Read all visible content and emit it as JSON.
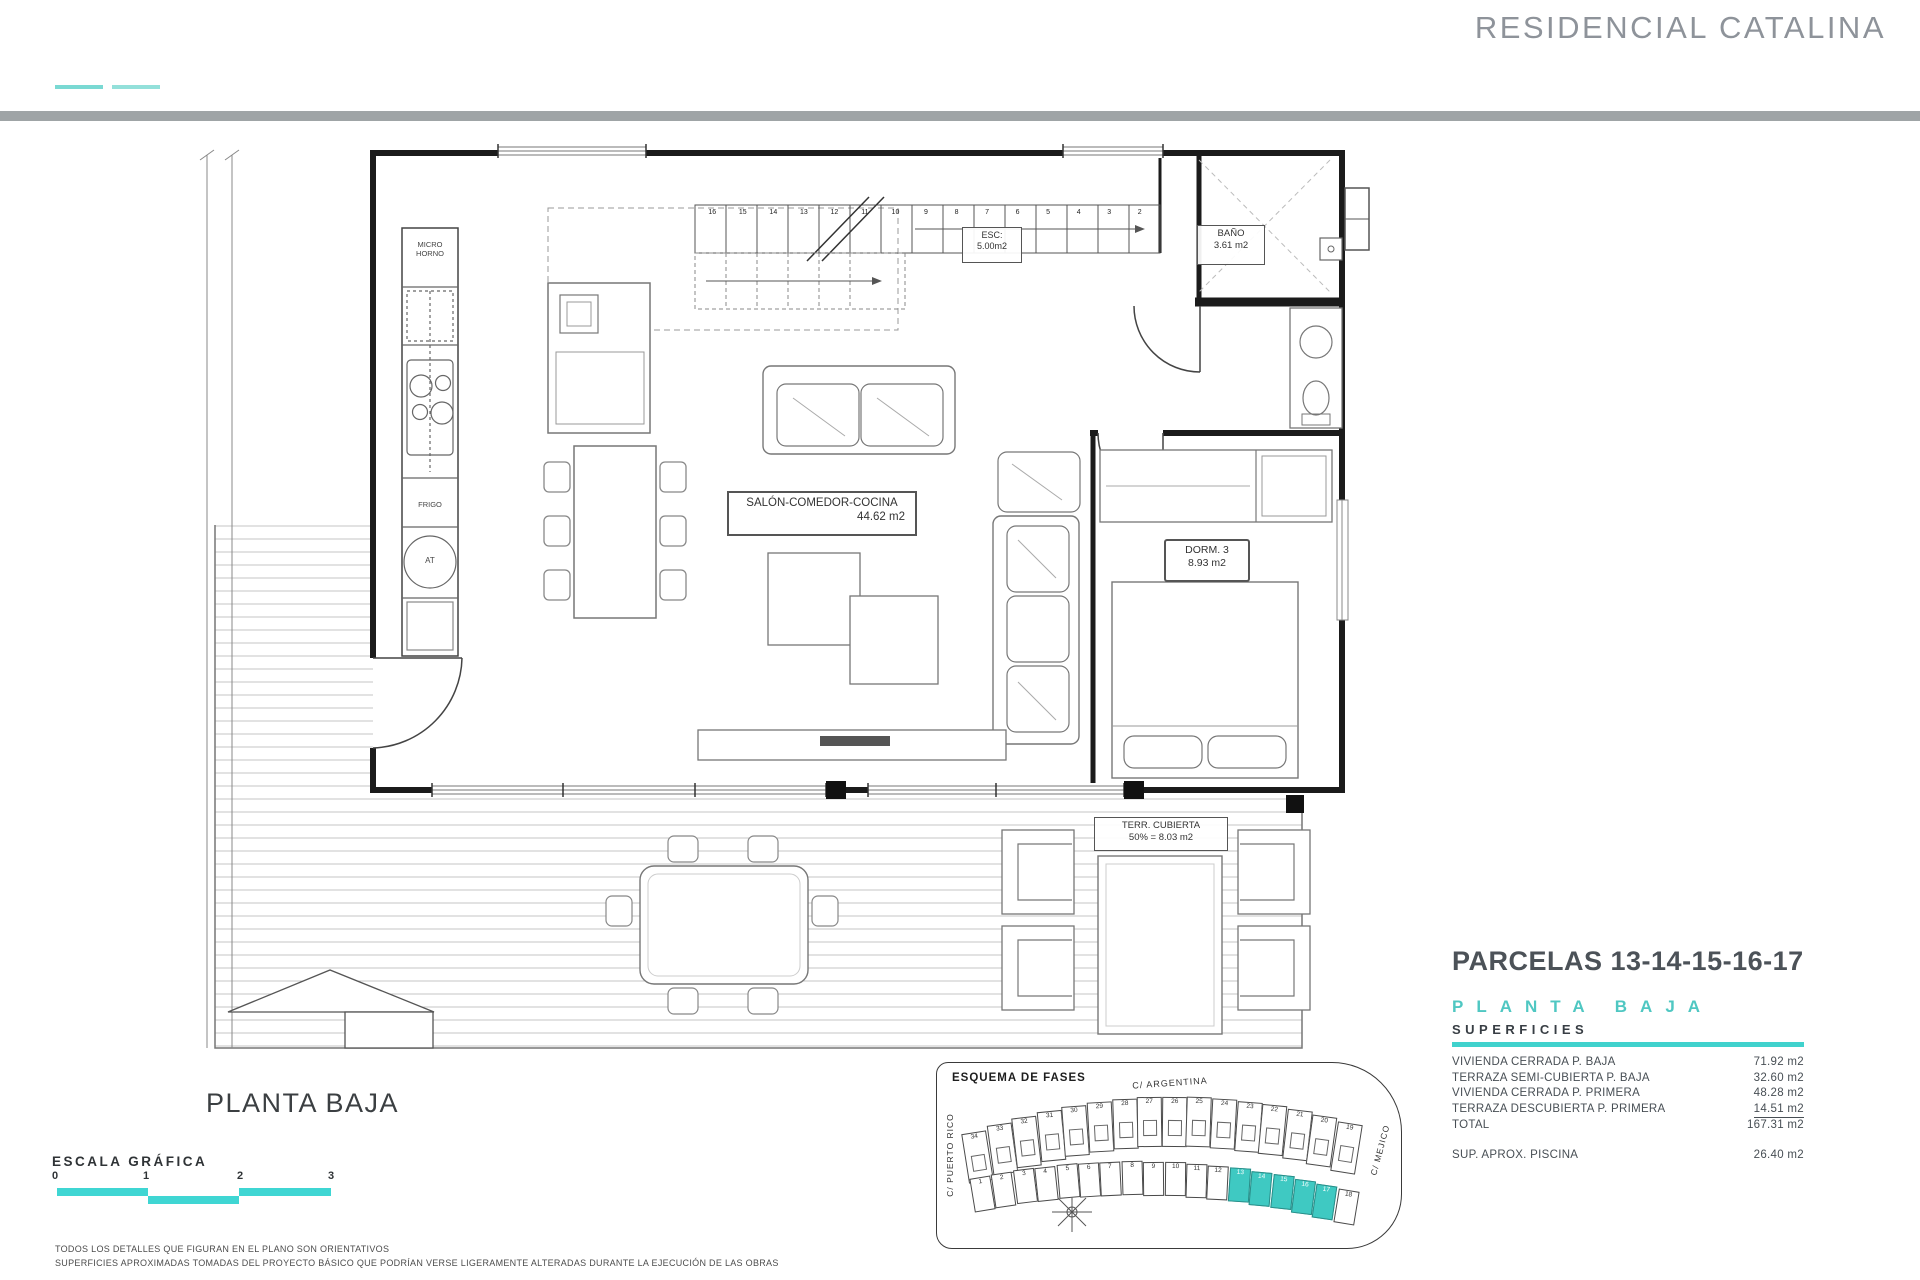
{
  "header": {
    "title": "RESIDENCIAL CATALINA"
  },
  "plan_labels": {
    "micro": "MICRO\nHORNO",
    "frigo": "FRIGO",
    "at": "AT",
    "esc_line1": "ESC:",
    "esc_line2": "5.00m2",
    "bano_line1": "BAÑO",
    "bano_line2": "3.61 m2",
    "salon_line1": "SALÓN-COMEDOR-COCINA",
    "salon_line2": "44.62 m2",
    "dorm_line1": "DORM. 3",
    "dorm_line2": "8.93 m2",
    "terr_line1": "TERR. CUBIERTA",
    "terr_line2": "50% = 8.03 m2"
  },
  "stairs": {
    "numbers": [
      "16",
      "15",
      "14",
      "13",
      "12",
      "11",
      "10",
      "9",
      "8",
      "7",
      "6",
      "5",
      "4",
      "3",
      "2"
    ]
  },
  "titles": {
    "plan_title": "PLANTA BAJA"
  },
  "scale": {
    "title": "ESCALA GRÁFICA",
    "ticks": [
      "0",
      "1",
      "2",
      "3"
    ]
  },
  "disclaimer": {
    "line1": "TODOS LOS DETALLES QUE FIGURAN EN EL PLANO SON ORIENTATIVOS",
    "line2": "SUPERFICIES APROXIMADAS TOMADAS DEL PROYECTO BÁSICO QUE PODRÍAN VERSE LIGERAMENTE ALTERADAS DURANTE LA EJECUCIÓN DE LAS OBRAS"
  },
  "info": {
    "parcels_title": "PARCELAS 13-14-15-16-17",
    "floor_title": "PLANTA BAJA",
    "section_title": "SUPERFICIES",
    "rows": [
      {
        "label": "VIVIENDA CERRADA P. BAJA",
        "value": "71.92 m2",
        "underline": false
      },
      {
        "label": "TERRAZA SEMI-CUBIERTA P. BAJA",
        "value": "32.60 m2",
        "underline": false
      },
      {
        "label": "VIVIENDA CERRADA P. PRIMERA",
        "value": "48.28 m2",
        "underline": false
      },
      {
        "label": "TERRAZA DESCUBIERTA P. PRIMERA",
        "value": "14.51 m2",
        "underline": true
      },
      {
        "label": "TOTAL",
        "value": "167.31 m2",
        "underline": false
      }
    ],
    "piscina": {
      "label": "SUP. APROX. PISCINA",
      "value": "26.40 m2"
    }
  },
  "site_plan": {
    "title": "ESQUEMA DE FASES",
    "streets": {
      "top": "C/ ARGENTINA",
      "left": "C/ PUERTO RICO",
      "bottom": "C/ CHILE",
      "right": "C/ MEJICO"
    },
    "top_row": [
      "34",
      "33",
      "32",
      "31",
      "30",
      "29",
      "28",
      "27",
      "26",
      "25",
      "24",
      "23",
      "22",
      "21",
      "20",
      "19"
    ],
    "bottom_row": [
      "1",
      "2",
      "3",
      "4",
      "5",
      "6",
      "7",
      "8",
      "9",
      "10",
      "11",
      "12",
      "13",
      "14",
      "15",
      "16",
      "17",
      "18"
    ],
    "highlighted": [
      "13",
      "14",
      "15",
      "16",
      "17"
    ],
    "highlight_color": "#3fc9c2"
  },
  "colors": {
    "teal": "#40d2cd",
    "header_gray": "#9fa4a6",
    "title_gray": "#8e939a"
  }
}
